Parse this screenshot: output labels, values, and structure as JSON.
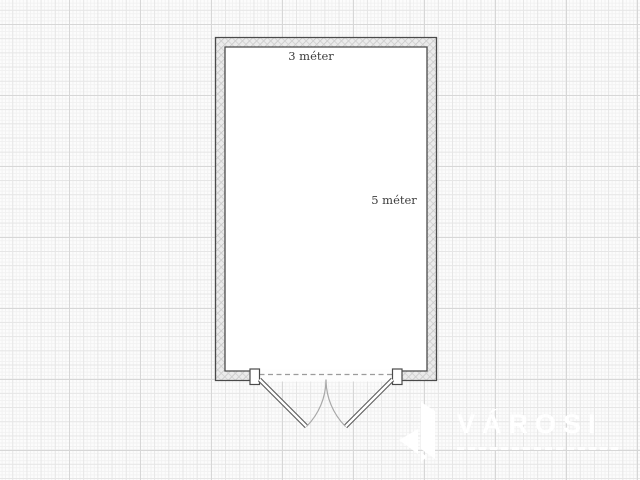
{
  "canvas": {
    "background_color": "#fcfcfc",
    "grid": {
      "major_color": "#d7d7d7",
      "medium_color": "#e6e6e6",
      "fine_color": "#f1f1f1",
      "major_spacing_px": 71
    }
  },
  "floorplan": {
    "room": {
      "width_label": "3 méter",
      "length_label": "5 méter",
      "floor_color": "#ffffff",
      "wall_fill": "#ebebeb",
      "wall_hatch_color": "#c2c2c2",
      "wall_outline_color": "#4a4a4a"
    },
    "door": {
      "type": "double-swing",
      "leaf_count": 2,
      "leaf_color": "#5a5a5a",
      "swing_arc_color": "#a8a8a8",
      "threshold_dash_color": "#9b9b9b",
      "jamb_fill": "#ffffff"
    },
    "label_color": "#3c3c3c"
  },
  "watermark": {
    "brand": "VÁROSI",
    "color": "#ffffff"
  }
}
